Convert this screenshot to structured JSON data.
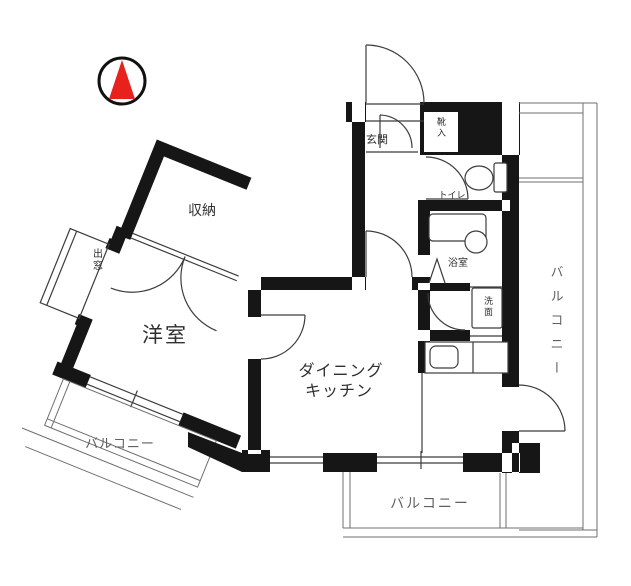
{
  "title": "apartment-floor-plan",
  "colors": {
    "wall": "#161616",
    "line": "#3c3c3c",
    "rail": "#6f6f6f",
    "compass_red": "#e8211d",
    "text": "#2f2f2f",
    "text_muted": "#5f5f5f"
  },
  "labels": {
    "storage": "収納",
    "bay_window": "出窓",
    "western_room": "洋室",
    "balcony_left": "バルコニー",
    "dining_kitchen_line1": "ダイニング",
    "dining_kitchen_line2": "キッチン",
    "balcony_bottom": "バルコニー",
    "balcony_right": "バルコニー",
    "entrance": "玄関",
    "shoe_cabinet": "靴入",
    "toilet": "トイレ",
    "bathroom": "浴室",
    "washroom": "洗面"
  }
}
